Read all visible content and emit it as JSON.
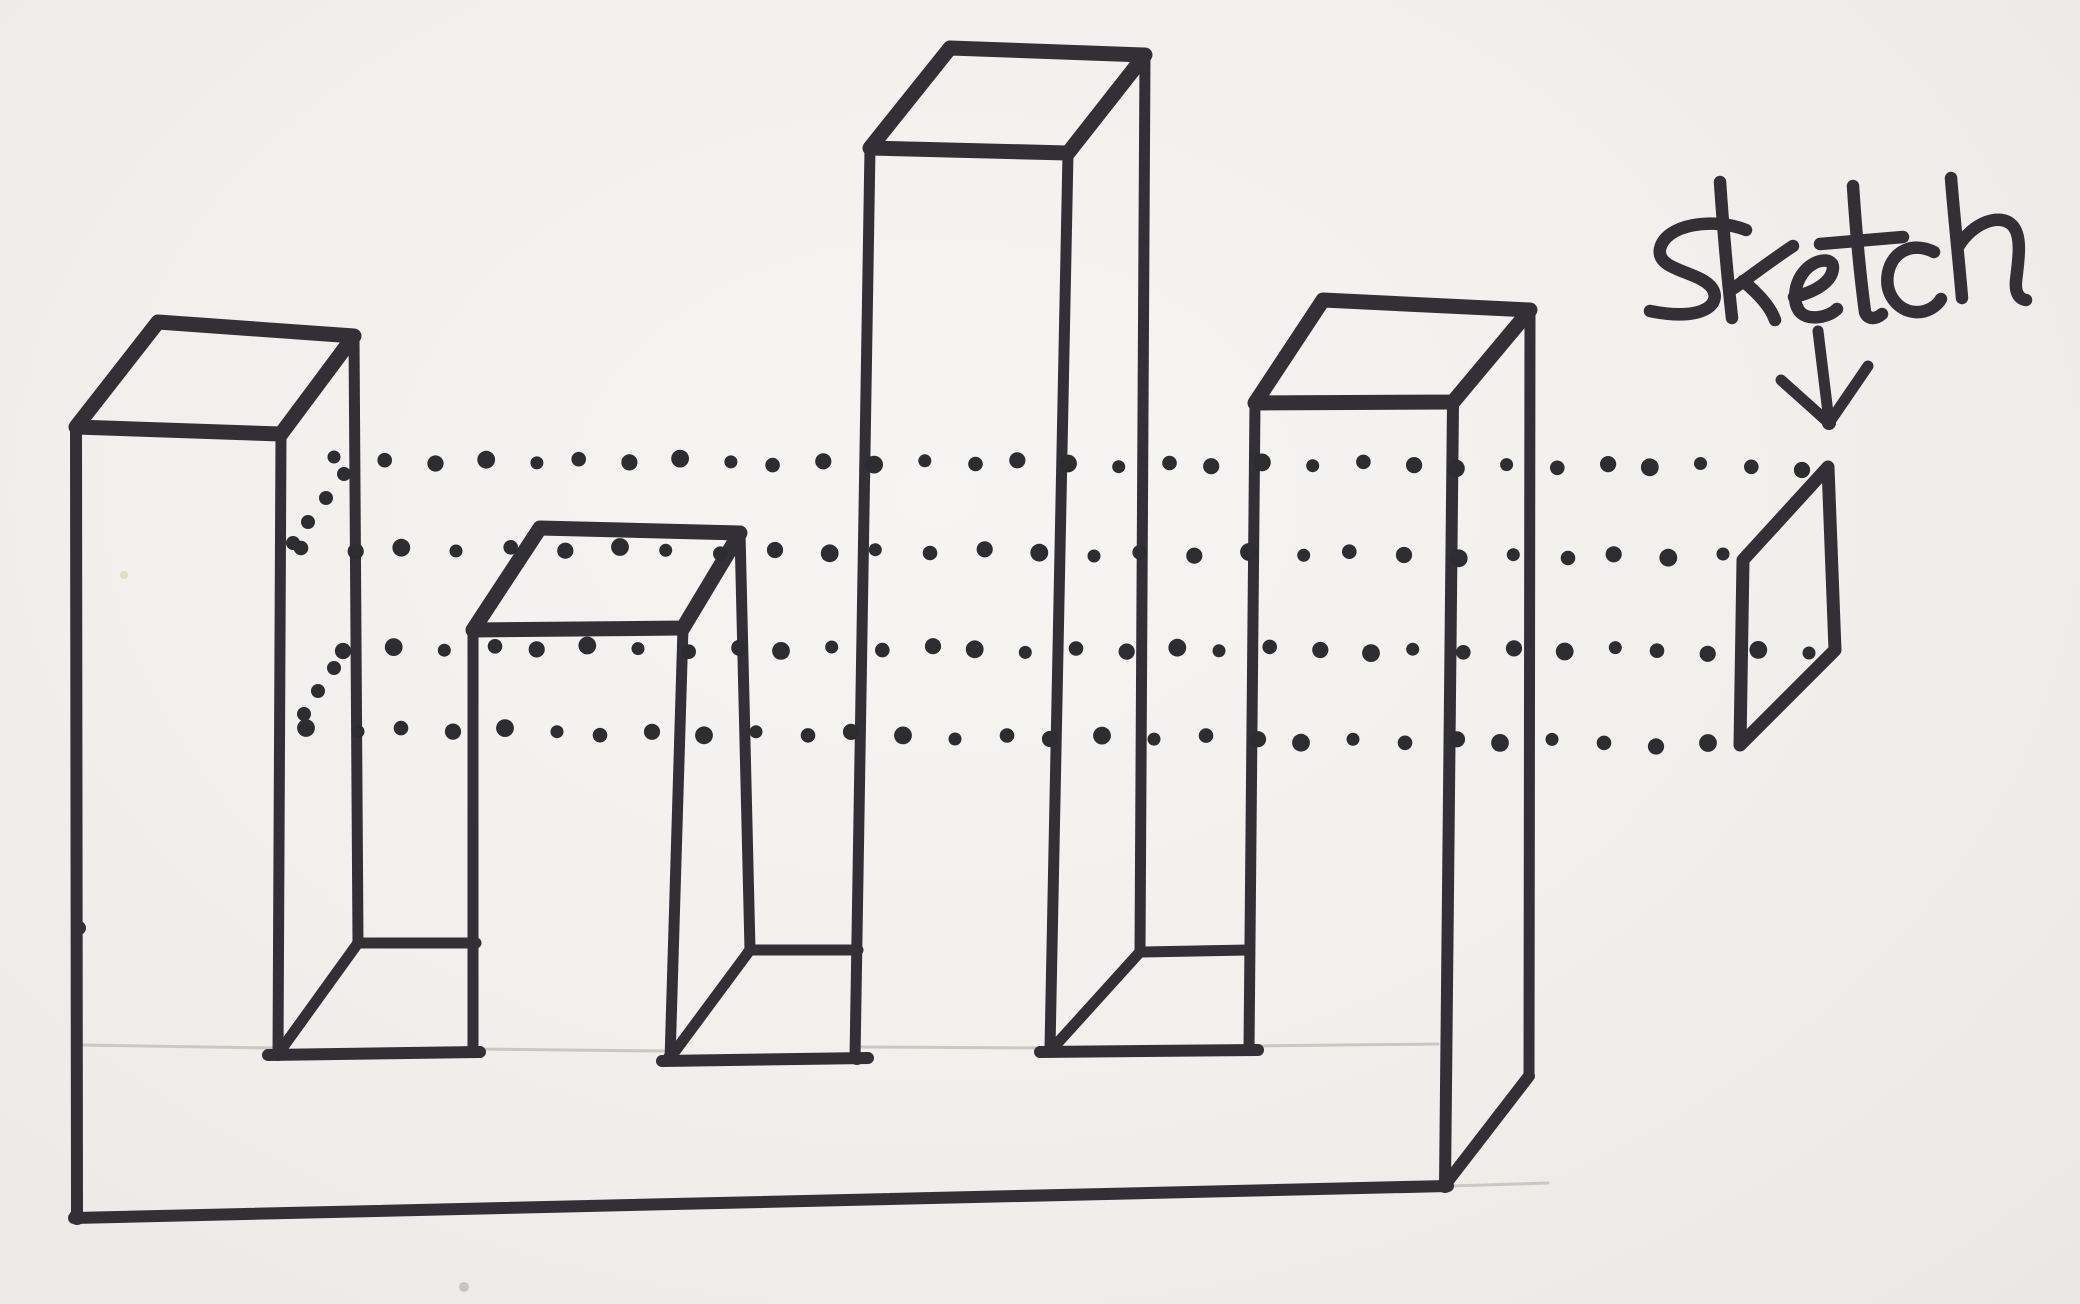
{
  "page": {
    "background": "#f2f0ed",
    "ink": "#323036",
    "dot_ink": "#2d2c31",
    "pencil": "#c7c3bc"
  },
  "annotation": {
    "label": "sketch",
    "arrow_strokes": [
      {
        "name": "arrow-shaft",
        "pts": [
          [
            1818,
            331
          ],
          [
            1829,
            421
          ]
        ]
      },
      {
        "name": "arrow-left-wing",
        "pts": [
          [
            1781,
            380
          ],
          [
            1829,
            423
          ]
        ]
      },
      {
        "name": "arrow-right-wing",
        "pts": [
          [
            1868,
            366
          ],
          [
            1829,
            423
          ]
        ]
      }
    ],
    "letter_paths": [
      {
        "name": "letter-s",
        "d": "M1746,230 C1714,217 1665,224 1660,249 C1656,271 1700,271 1712,288 C1722,303 1705,322 1650,311"
      },
      {
        "name": "letter-k-stem",
        "d": "M1720,182 C1723,226 1728,282 1732,318"
      },
      {
        "name": "letter-k-arm",
        "d": "M1793,246 C1769,262 1751,276 1734,288"
      },
      {
        "name": "letter-k-leg",
        "d": "M1743,281 C1760,295 1771,308 1775,320"
      },
      {
        "name": "letter-e",
        "d": "M1794,297 C1815,292 1832,282 1833,268 C1833,256 1813,259 1803,273 C1794,285 1792,304 1801,313 C1810,321 1829,317 1837,309"
      },
      {
        "name": "letter-t-stem",
        "d": "M1853,186 C1856,232 1861,282 1865,312 C1867,319 1875,320 1882,314"
      },
      {
        "name": "letter-t-cross",
        "d": "M1820,244 L1903,237"
      },
      {
        "name": "letter-c",
        "d": "M1934,252 C1912,241 1892,252 1888,273 C1884,295 1899,311 1915,312 C1927,313 1937,306 1941,299"
      },
      {
        "name": "letter-h-stem",
        "d": "M1951,178 C1954,216 1959,262 1962,298"
      },
      {
        "name": "letter-h-hump",
        "d": "M1958,247 C1973,222 2000,213 2012,225 C2023,236 2018,262 2016,281 C2015,293 2019,299 2026,300"
      }
    ],
    "letter_stroke_width": 12.5,
    "arrow_stroke_width": 11
  },
  "drawing": {
    "ink_strokes": [
      {
        "name": "box1-top-face",
        "w": 15,
        "closed": true,
        "pts": [
          [
            158,
            322
          ],
          [
            354,
            336
          ],
          [
            281,
            434
          ],
          [
            76,
            427
          ]
        ]
      },
      {
        "name": "box1-front-left-edge",
        "w": 12,
        "closed": false,
        "pts": [
          [
            76,
            427
          ],
          [
            77,
            1217
          ]
        ]
      },
      {
        "name": "box1-front-right-edge",
        "w": 11,
        "closed": false,
        "pts": [
          [
            281,
            434
          ],
          [
            278,
            1054
          ]
        ]
      },
      {
        "name": "box1-back-right-edge",
        "w": 11,
        "closed": false,
        "pts": [
          [
            354,
            336
          ],
          [
            358,
            943
          ]
        ]
      },
      {
        "name": "channel1-back-edge",
        "w": 11,
        "closed": false,
        "pts": [
          [
            358,
            943
          ],
          [
            476,
            943
          ]
        ]
      },
      {
        "name": "channel1-wall-diagonal",
        "w": 11,
        "closed": false,
        "pts": [
          [
            358,
            943
          ],
          [
            278,
            1054
          ]
        ]
      },
      {
        "name": "channel1-front-edge",
        "w": 12,
        "closed": false,
        "pts": [
          [
            268,
            1055
          ],
          [
            480,
            1052
          ]
        ]
      },
      {
        "name": "box2-top-face",
        "w": 15,
        "closed": true,
        "pts": [
          [
            540,
            528
          ],
          [
            740,
            533
          ],
          [
            683,
            628
          ],
          [
            473,
            630
          ]
        ]
      },
      {
        "name": "box2-front-left-edge",
        "w": 11,
        "closed": false,
        "pts": [
          [
            473,
            630
          ],
          [
            473,
            1052
          ]
        ]
      },
      {
        "name": "box2-front-right-edge",
        "w": 11,
        "closed": false,
        "pts": [
          [
            683,
            628
          ],
          [
            670,
            1060
          ]
        ]
      },
      {
        "name": "box2-back-right-edge",
        "w": 11,
        "closed": false,
        "pts": [
          [
            740,
            533
          ],
          [
            750,
            950
          ]
        ]
      },
      {
        "name": "channel2-back-edge",
        "w": 11,
        "closed": false,
        "pts": [
          [
            750,
            950
          ],
          [
            858,
            950
          ]
        ]
      },
      {
        "name": "channel2-wall-diagonal",
        "w": 11,
        "closed": false,
        "pts": [
          [
            750,
            950
          ],
          [
            670,
            1058
          ]
        ]
      },
      {
        "name": "channel2-front-edge",
        "w": 12,
        "closed": false,
        "pts": [
          [
            662,
            1061
          ],
          [
            868,
            1058
          ]
        ]
      },
      {
        "name": "box3-top-face",
        "w": 15,
        "closed": true,
        "pts": [
          [
            950,
            48
          ],
          [
            1145,
            55
          ],
          [
            1068,
            153
          ],
          [
            870,
            148
          ]
        ]
      },
      {
        "name": "box3-front-left-edge",
        "w": 11,
        "closed": false,
        "pts": [
          [
            870,
            148
          ],
          [
            855,
            1058
          ]
        ]
      },
      {
        "name": "box3-front-right-edge",
        "w": 11,
        "closed": false,
        "pts": [
          [
            1068,
            153
          ],
          [
            1050,
            1048
          ]
        ]
      },
      {
        "name": "box3-back-right-edge",
        "w": 11,
        "closed": false,
        "pts": [
          [
            1145,
            55
          ],
          [
            1140,
            952
          ]
        ]
      },
      {
        "name": "channel3-back-edge",
        "w": 11,
        "closed": false,
        "pts": [
          [
            1140,
            952
          ],
          [
            1248,
            950
          ]
        ]
      },
      {
        "name": "channel3-wall-diagonal",
        "w": 11,
        "closed": false,
        "pts": [
          [
            1140,
            952
          ],
          [
            1053,
            1048
          ]
        ]
      },
      {
        "name": "channel3-front-edge",
        "w": 12,
        "closed": false,
        "pts": [
          [
            1040,
            1052
          ],
          [
            1258,
            1050
          ]
        ]
      },
      {
        "name": "box4-top-face",
        "w": 15,
        "closed": true,
        "pts": [
          [
            1323,
            300
          ],
          [
            1530,
            310
          ],
          [
            1453,
            402
          ],
          [
            1255,
            403
          ]
        ]
      },
      {
        "name": "box4-front-left-edge",
        "w": 11,
        "closed": false,
        "pts": [
          [
            1255,
            403
          ],
          [
            1249,
            1049
          ]
        ]
      },
      {
        "name": "box4-front-right-edge",
        "w": 12,
        "closed": false,
        "pts": [
          [
            1453,
            402
          ],
          [
            1445,
            1185
          ]
        ]
      },
      {
        "name": "box4-back-right-edge",
        "w": 11,
        "closed": false,
        "pts": [
          [
            1530,
            310
          ],
          [
            1529,
            1076
          ]
        ]
      },
      {
        "name": "base-bottom-edge",
        "w": 12,
        "closed": false,
        "pts": [
          [
            74,
            1218
          ],
          [
            1448,
            1186
          ]
        ]
      },
      {
        "name": "base-right-bottom-edge",
        "w": 12,
        "closed": false,
        "pts": [
          [
            1445,
            1185
          ],
          [
            1529,
            1076
          ]
        ]
      }
    ],
    "sketch_profile": {
      "name": "sketch-profile-parallelogram",
      "w": 13,
      "pts": [
        [
          1743,
          560
        ],
        [
          1828,
          467
        ],
        [
          1835,
          650
        ],
        [
          1740,
          745
        ]
      ]
    },
    "pencil_lines": [
      {
        "name": "pencil-base-top-left",
        "w": 3,
        "pts": [
          [
            82,
            1045
          ],
          [
            274,
            1048
          ]
        ]
      },
      {
        "name": "pencil-base-top-mid1",
        "w": 3,
        "pts": [
          [
            476,
            1049
          ],
          [
            664,
            1051
          ]
        ]
      },
      {
        "name": "pencil-base-top-mid2",
        "w": 3,
        "pts": [
          [
            858,
            1047
          ],
          [
            1048,
            1048
          ]
        ]
      },
      {
        "name": "pencil-base-top-right",
        "w": 3,
        "pts": [
          [
            1252,
            1046
          ],
          [
            1438,
            1044
          ]
        ]
      },
      {
        "name": "pencil-base-bottom-ext",
        "w": 3,
        "pts": [
          [
            1450,
            1186
          ],
          [
            1548,
            1183
          ]
        ]
      }
    ],
    "ink_nodes": [
      [
        79,
        928,
        7
      ],
      [
        77,
        1217,
        8
      ],
      [
        278,
        1054,
        7
      ],
      [
        358,
        943,
        6
      ],
      [
        473,
        943,
        6
      ],
      [
        670,
        1058,
        7
      ],
      [
        750,
        950,
        6
      ],
      [
        857,
        1058,
        7
      ],
      [
        1053,
        1048,
        7
      ],
      [
        1140,
        952,
        6
      ],
      [
        1249,
        1049,
        7
      ],
      [
        1445,
        1185,
        8
      ],
      [
        1829,
        423,
        7
      ]
    ],
    "dotted_rows": [
      {
        "name": "projection-row-1",
        "from": [
          338,
          460
        ],
        "to": [
          1800,
          467
        ],
        "spacing": 48,
        "r": 8
      },
      {
        "name": "projection-row-2",
        "from": [
          300,
          548
        ],
        "to": [
          1722,
          557
        ],
        "spacing": 52,
        "r": 8
      },
      {
        "name": "projection-row-3",
        "from": [
          346,
          648
        ],
        "to": [
          1806,
          651
        ],
        "spacing": 48,
        "r": 8
      },
      {
        "name": "projection-row-4",
        "from": [
          304,
          729
        ],
        "to": [
          1704,
          744
        ],
        "spacing": 50,
        "r": 8
      }
    ],
    "diagonal_dots": [
      {
        "name": "projection-diagonal-1",
        "r": 7,
        "points": [
          [
            344,
            474
          ],
          [
            326,
            498
          ],
          [
            308,
            522
          ],
          [
            293,
            543
          ]
        ]
      },
      {
        "name": "projection-diagonal-2",
        "r": 7,
        "points": [
          [
            334,
            668
          ],
          [
            318,
            691
          ],
          [
            304,
            714
          ]
        ]
      }
    ],
    "specks": [
      {
        "x": 124,
        "y": 575,
        "r": 4,
        "color": "#e3dcc4"
      },
      {
        "x": 464,
        "y": 1287,
        "r": 5,
        "color": "#c9c6c0"
      }
    ]
  }
}
